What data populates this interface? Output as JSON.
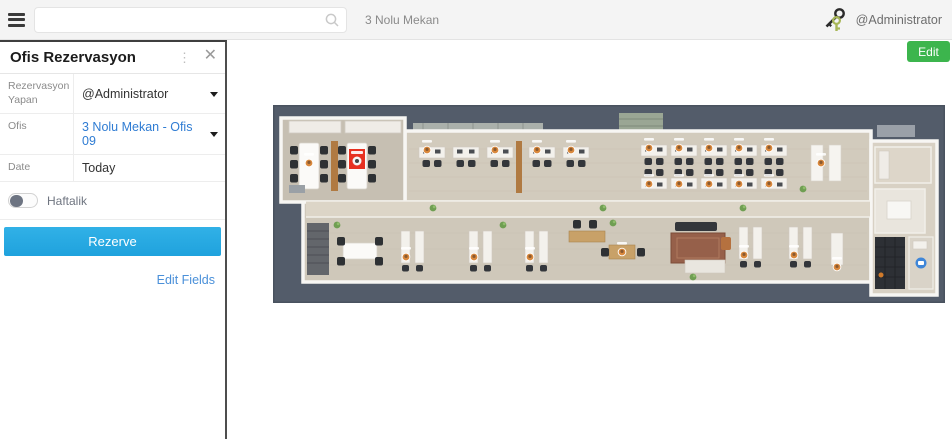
{
  "topbar": {
    "search_placeholder": "",
    "search_value": "",
    "location": "3 Nolu Mekan",
    "user": "@Administrator"
  },
  "panel": {
    "title": "Ofis Rezervasyon",
    "more_glyph": "⋮",
    "close_glyph": "✕",
    "fields": [
      {
        "label": "Rezervasyon Yapan",
        "value": "@Administrator",
        "type": "dropdown"
      },
      {
        "label": "Ofis",
        "value": "3 Nolu Mekan - Ofis 09",
        "type": "dropdown"
      },
      {
        "label": "Date",
        "value": "Today",
        "type": "text"
      }
    ],
    "toggle": {
      "label": "Haftalik",
      "state": "off"
    },
    "reserve_label": "Rezerve",
    "edit_fields_label": "Edit Fields"
  },
  "main": {
    "edit_label": "Edit",
    "floor_plan_alt": "Top-down 3D render of a long office floor: meeting rooms left with a red highlighted desk (selected Ofis 09), open-plan desks with orange user avatars, central corridor, lounge, and restroom at right on a dark slate background"
  },
  "icons": {
    "menu-icon": "hamburger",
    "search-icon": "magnifier",
    "keys-icon": "key-pair",
    "more-options-icon": "vertical-dots",
    "close-icon": "x",
    "chevron-down-icon": "caret-down",
    "selected-desk-marker": "red-square"
  },
  "colors": {
    "topbar_background": "#f4f4f4",
    "reserve_button": "#27a9e0",
    "value_blue": "#2f7cd3",
    "link_blue": "#4a90d9",
    "edit_button_green": "#3cb54d",
    "selected_desk_red": "#e73020",
    "floor_plan_background": "#535c6a",
    "panel_border": "#4e4e4e"
  }
}
